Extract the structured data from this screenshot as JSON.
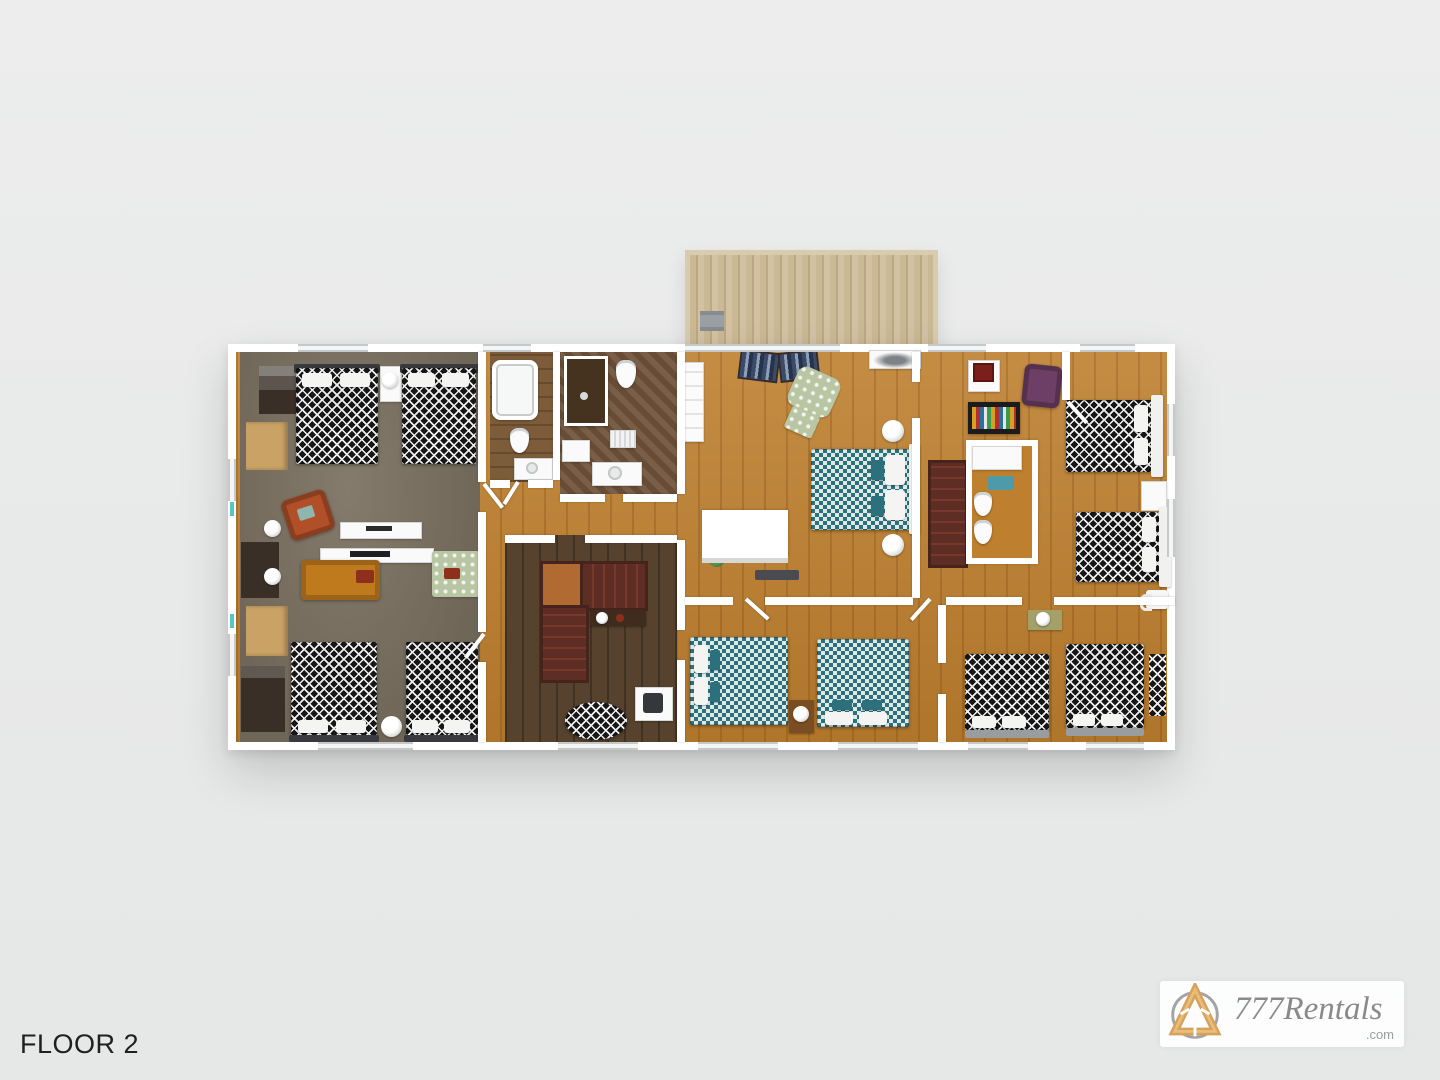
{
  "title": {
    "floor_label": "FLOOR 2"
  },
  "branding": {
    "name": "777Rentals",
    "tld": ".com"
  },
  "palette": {
    "pagebg": "#e9eaea",
    "wall": "#ffffff",
    "wood": "#be7f2e",
    "darkwood": "#56422d",
    "carpet": "#7b7161",
    "tile": "#6e5138",
    "bathwood": "#7d5c39",
    "deckc": "#c9b693",
    "stairs": "#5e2e24",
    "landing": "#b06a32",
    "teal": "#2c707c",
    "tealpale": "#dfe9e6",
    "bwdark": "#161616",
    "bwlight": "#efefef",
    "sofa": "#bf7a1e",
    "cushion": "#8e2f1d",
    "rust": "#b14f28",
    "purple": "#6d3f66",
    "floral": "#b9c6a4",
    "gold": "#d7a158",
    "logogray": "#8a8a8a",
    "textdark": "#202022",
    "tealtick": "#57c7c2"
  }
}
